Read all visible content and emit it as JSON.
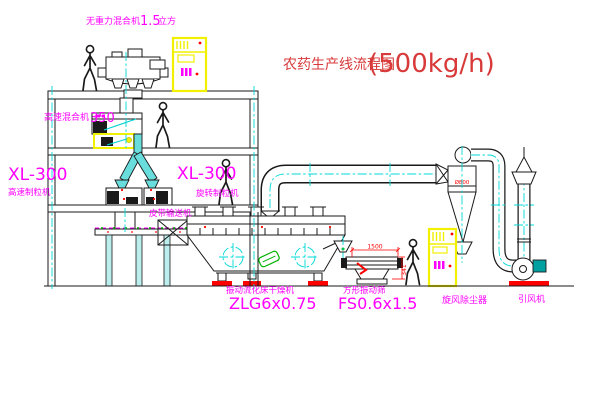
{
  "title": {
    "cn": "农药生产线流程图",
    "capacity": "(500kg/h)"
  },
  "labels": {
    "top_mixer": {
      "name": "无重力混合机",
      "value": "1.5",
      "unit": "立方"
    },
    "hs_mixer": {
      "name": "高速混合机",
      "value": "350"
    },
    "granulator_left": {
      "model": "XL-300",
      "name": "高速制粒机"
    },
    "granulator_right": {
      "model": "XL-300",
      "name": "旋转制粒机"
    },
    "belt_conveyor": "皮带输送机",
    "dryer": {
      "name": "振动流化床干燥机",
      "model": "ZLG6x0.75"
    },
    "screen": {
      "name": "方形振动筛",
      "model": "FS0.6x1.5"
    },
    "cyclone": "旋风除尘器",
    "fan": "引风机"
  },
  "dimensions": {
    "screen_width": "1500",
    "screen_height": "341",
    "cyclone_dia": "Ø800"
  },
  "colors": {
    "line_black": "#1a1a1a",
    "label_magenta": "#ff00ff",
    "title_red": "#d83a3a",
    "accent_red": "#ff0000",
    "centerline_cyan": "#00d8d8",
    "cabinet_yellow": "#f0f000",
    "valve_green": "#00b400",
    "motor_teal": "#00a0a0",
    "pipe_fill_cyan": "#69dcdc"
  }
}
